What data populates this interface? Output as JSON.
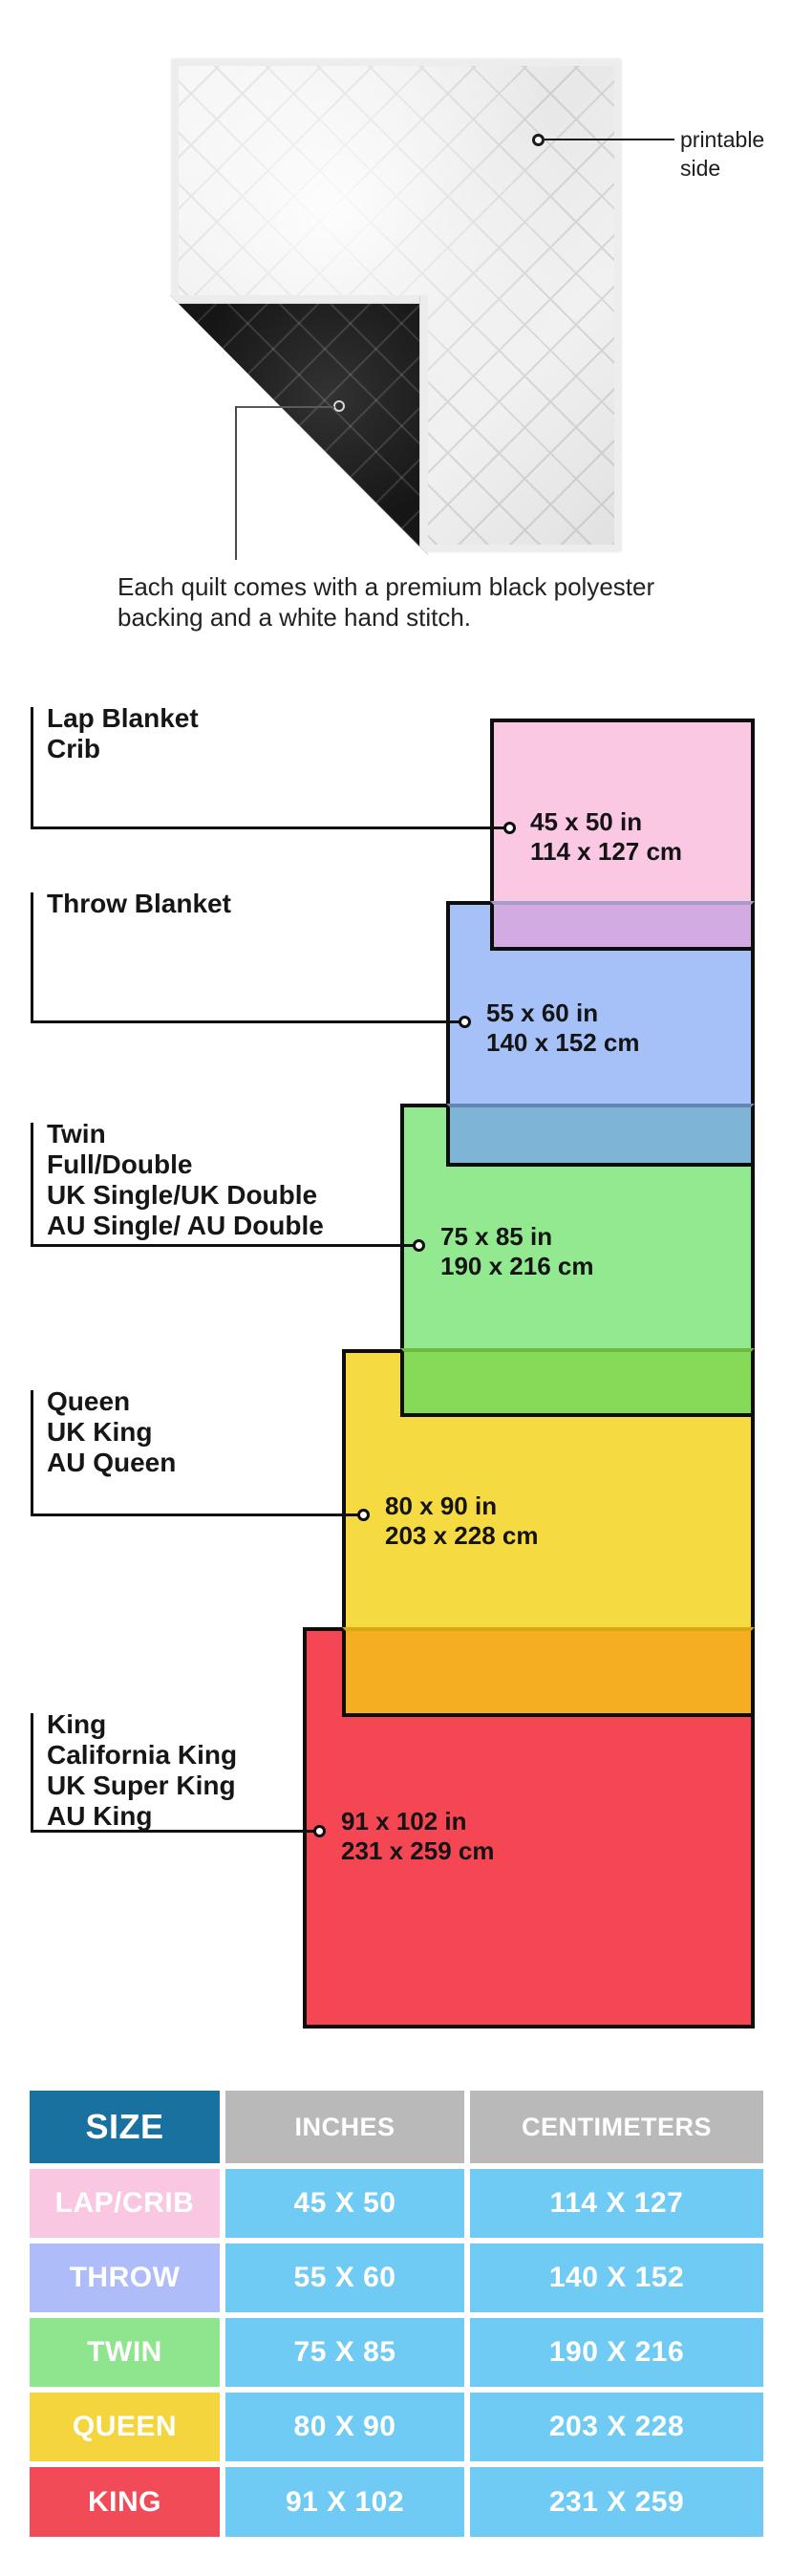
{
  "quilt_info": {
    "printable_lines": [
      "printable",
      "side"
    ],
    "caption_lines": [
      "Each quilt comes with a premium black polyester",
      "backing and a white hand stitch."
    ]
  },
  "size_diagram": {
    "border_color": "#0d0d0d",
    "items": [
      {
        "id": "lap",
        "label_lines": [
          "Lap Blanket",
          "Crib"
        ],
        "inches": "45 x 50 in",
        "cm": "114 x 127 cm",
        "fill": "#FAC8E3",
        "overlap_fill": "#D2ABE2",
        "seam_color": "#A89BC8"
      },
      {
        "id": "throw",
        "label_lines": [
          "Throw Blanket"
        ],
        "inches": "55 x 60 in",
        "cm": "140 x 152 cm",
        "fill": "#A5C1F8",
        "overlap_fill": "#7EB5D7",
        "seam_color": "#6585B5"
      },
      {
        "id": "twin",
        "label_lines": [
          "Twin",
          "Full/Double",
          "UK Single/UK Double",
          "AU Single/ AU Double"
        ],
        "inches": "75 x 85 in",
        "cm": "190 x 216 cm",
        "fill": "#92E98F",
        "overlap_fill": "#85DB58",
        "seam_color": "#6FB93F"
      },
      {
        "id": "queen",
        "label_lines": [
          "Queen",
          "UK King",
          "AU Queen"
        ],
        "inches": "80 x 90 in",
        "cm": "203 x 228 cm",
        "fill": "#F6DA41",
        "overlap_fill": "#F5AE21",
        "seam_color": "#D9A810"
      },
      {
        "id": "king",
        "label_lines": [
          "King",
          "California King",
          "UK Super King",
          "AU King"
        ],
        "inches": "91 x 102 in",
        "cm": "231 x 259 cm",
        "fill": "#F44753"
      }
    ]
  },
  "size_table": {
    "headers": {
      "size": "SIZE",
      "inches": "INCHES",
      "cm": "CENTIMETERS"
    },
    "colors": {
      "size_header_bg": "#19719F",
      "other_header_bg": "#B9B9B9",
      "value_bg": "#70CBF4"
    },
    "rows": [
      {
        "label": "LAP/CRIB",
        "inches": "45 X 50",
        "cm": "114 X 127",
        "bg": "#F9C7E2"
      },
      {
        "label": "THROW",
        "inches": "55 X 60",
        "cm": "140 X 152",
        "bg": "#AEBDFA"
      },
      {
        "label": "TWIN",
        "inches": "75 X 85",
        "cm": "190 X 216",
        "bg": "#8FE58E"
      },
      {
        "label": "QUEEN",
        "inches": "80 X 90",
        "cm": "203 X 228",
        "bg": "#F5D53D"
      },
      {
        "label": "KING",
        "inches": "91 X 102",
        "cm": "231 X 259",
        "bg": "#F24B58"
      }
    ]
  }
}
